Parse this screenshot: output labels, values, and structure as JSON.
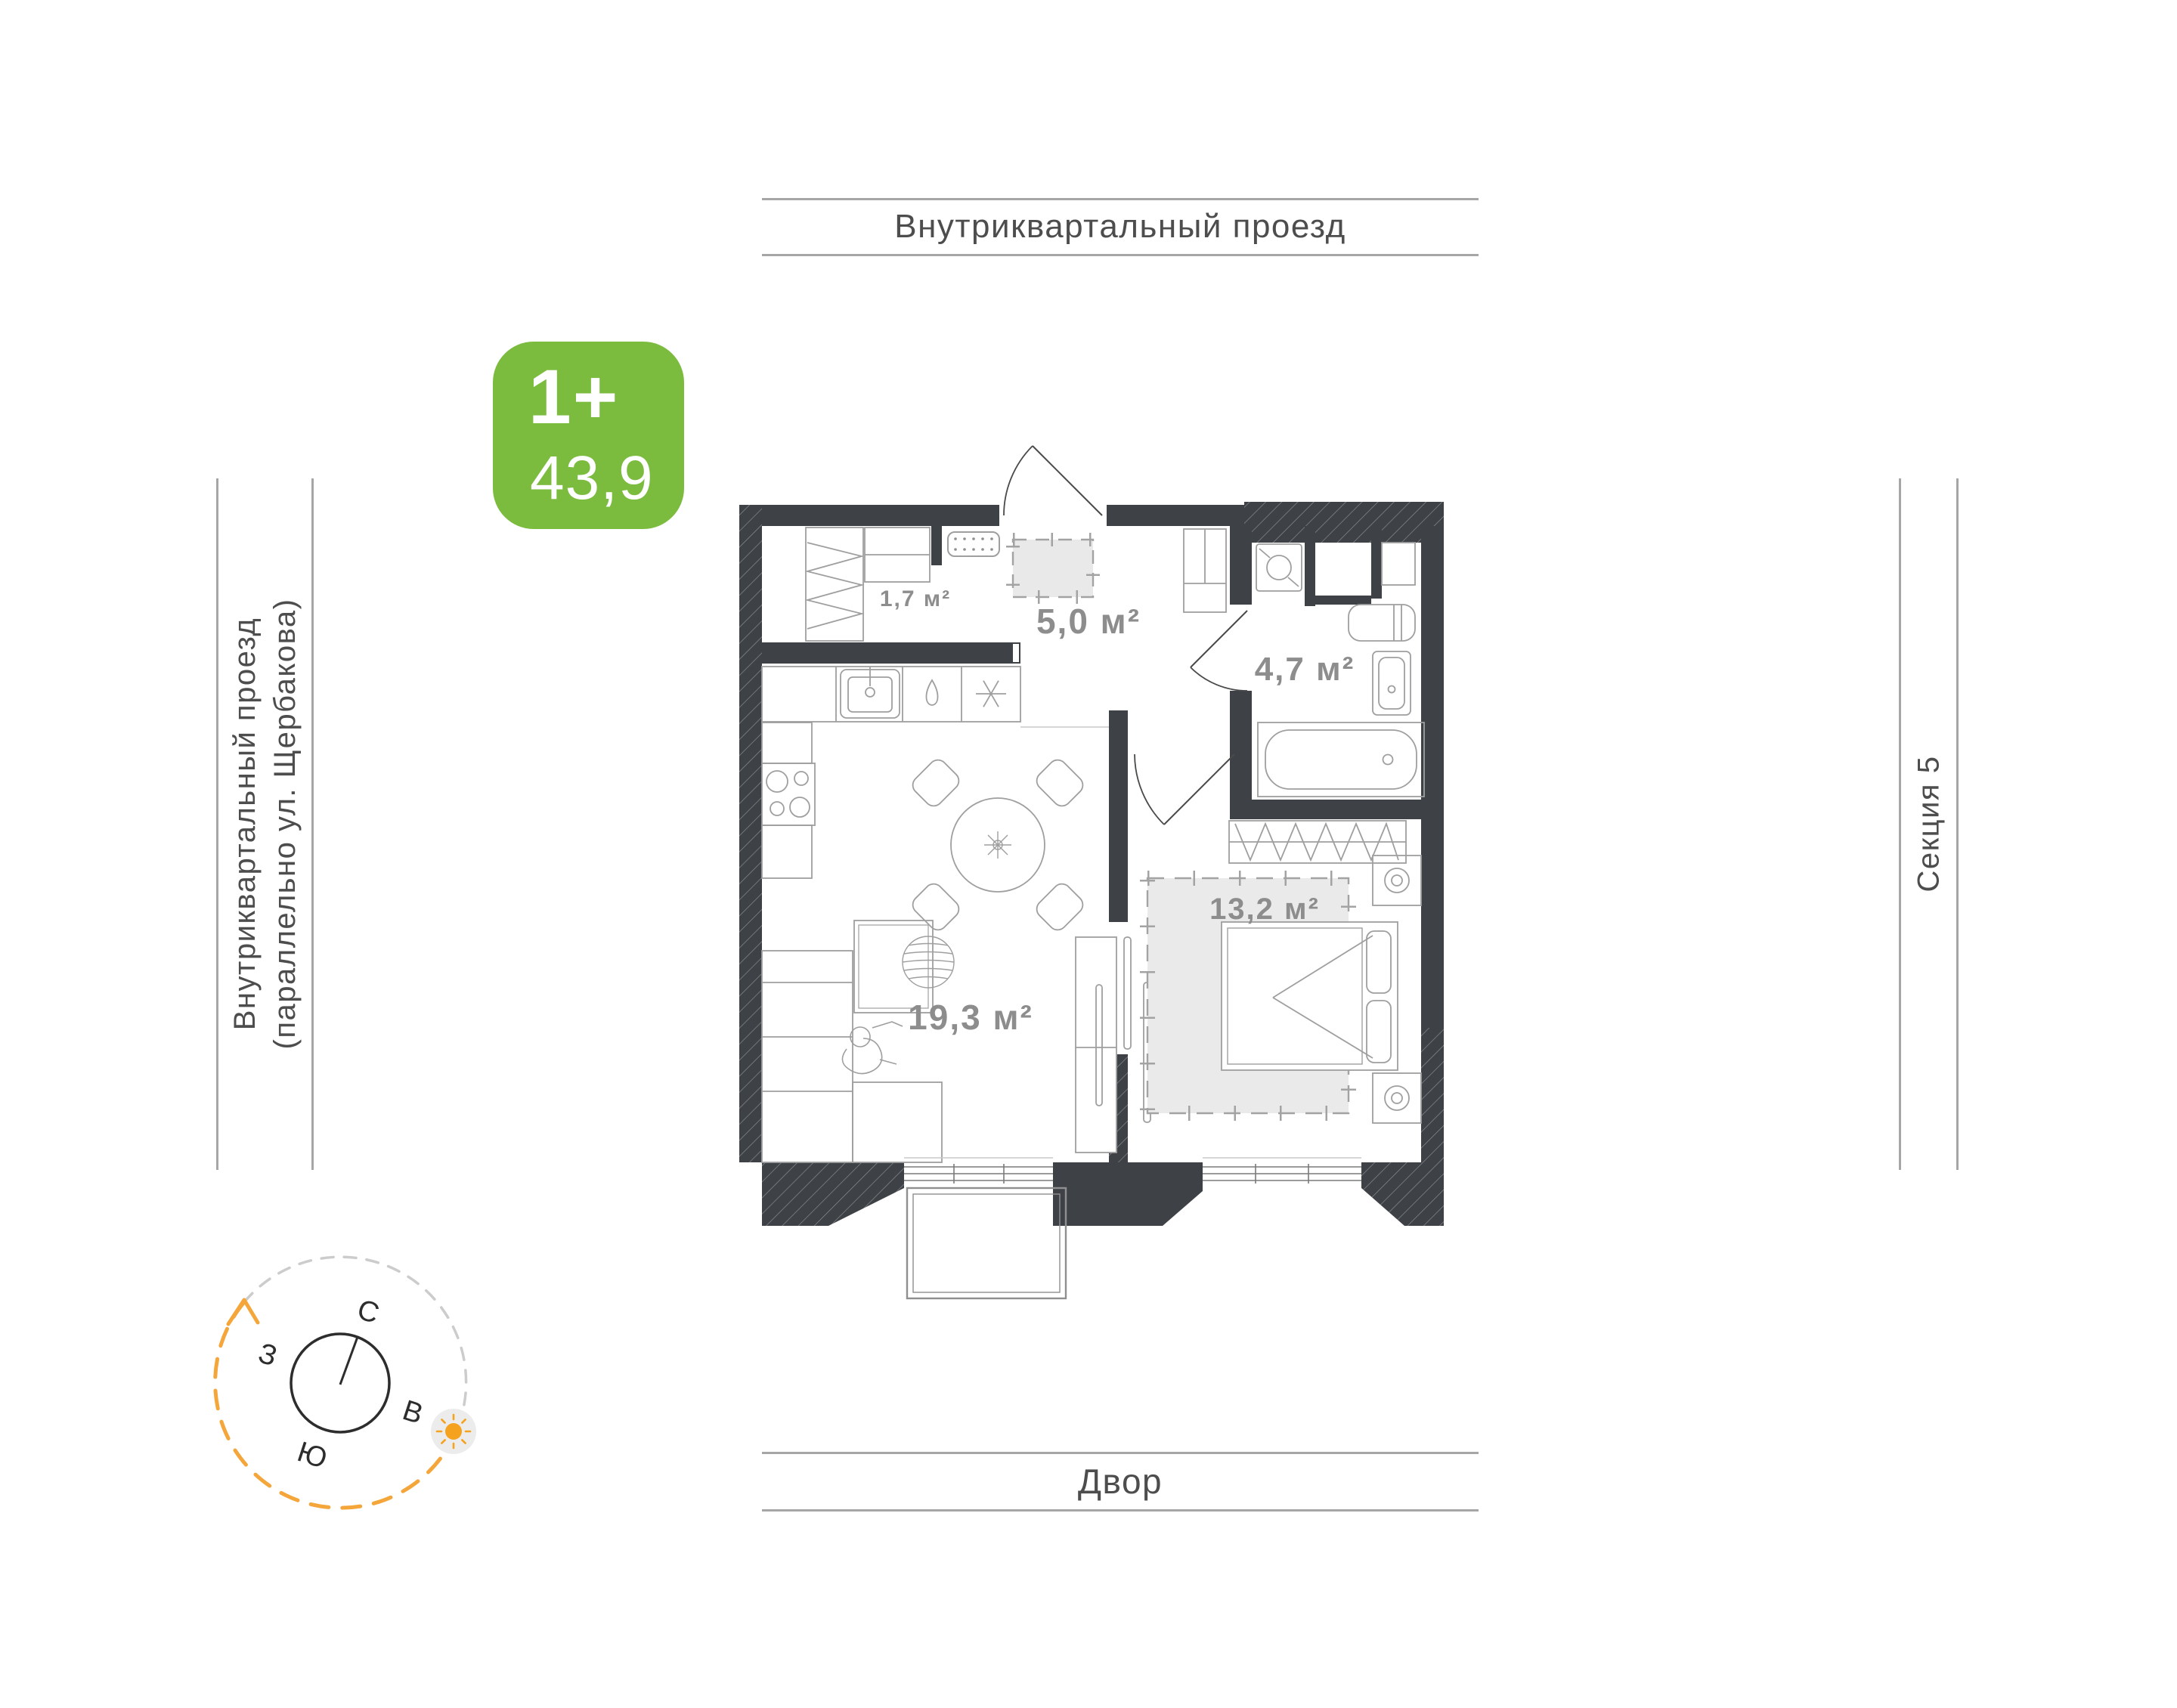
{
  "plan": {
    "badge": {
      "rooms_type": "1+",
      "total_area": "43,9"
    },
    "rooms": {
      "closet": "1,7 м²",
      "hall": "5,0 м²",
      "bathroom": "4,7 м²",
      "bedroom": "13,2 м²",
      "living": "19,3 м²"
    }
  },
  "surroundings": {
    "top_road": "Внутриквартальный проезд",
    "left_road_line1": "Внутриквартальный проезд",
    "left_road_line2": "(параллельно ул. Щербакова)",
    "right_section": "Секция 5",
    "bottom_yard": "Двор"
  },
  "compass": {
    "north": "С",
    "east": "В",
    "south": "Ю",
    "west": "З"
  },
  "colors": {
    "accent_green": "#7bbc3f",
    "sun_orange": "#f5a21f",
    "wall_dark": "#3e4247",
    "area_text_gray": "#8d8d8d",
    "guide_line_gray": "#a6a6a6"
  }
}
